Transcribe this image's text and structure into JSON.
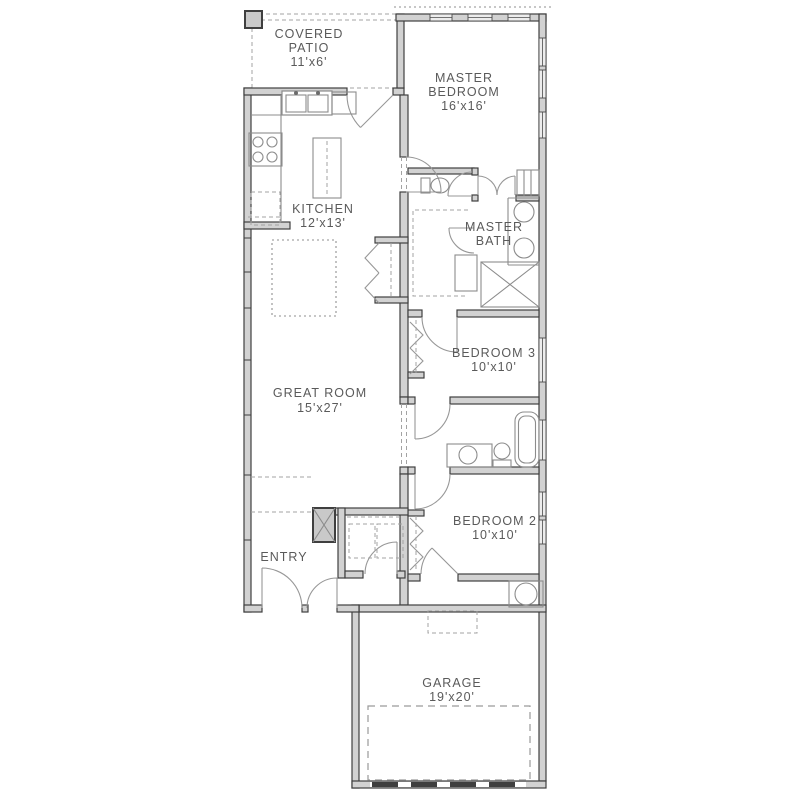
{
  "meta": {
    "type": "floor-plan-drawing",
    "background": "#ffffff"
  },
  "palette": {
    "wall_fill": "#d2d2d2",
    "wall_line": "#3f3f3f",
    "fixture_line": "#8c8c8c",
    "door_line": "#979797",
    "dashed_line": "#9a9a9a",
    "label_color": "#5a5a5a"
  },
  "rooms": {
    "covered_patio": {
      "name_line1": "COVERED",
      "name_line2": "PATIO",
      "dims": "11'x6'"
    },
    "master_bedroom": {
      "name_line1": "MASTER",
      "name_line2": "BEDROOM",
      "dims": "16'x16'"
    },
    "kitchen": {
      "name": "KITCHEN",
      "dims": "12'x13'"
    },
    "master_bath": {
      "name_line1": "MASTER",
      "name_line2": "BATH"
    },
    "great_room": {
      "name": "GREAT ROOM",
      "dims": "15'x27'"
    },
    "bedroom_3": {
      "name": "BEDROOM 3",
      "dims": "10'x10'"
    },
    "bedroom_2": {
      "name": "BEDROOM 2",
      "dims": "10'x10'"
    },
    "entry": {
      "name": "ENTRY"
    },
    "garage": {
      "name": "GARAGE",
      "dims": "19'x20'"
    }
  },
  "fixtures": [
    "kitchen-double-sink",
    "kitchen-range",
    "refrigerator-space",
    "kitchen-island",
    "pantry-bifold-doors",
    "master-toilet",
    "master-double-vanity",
    "walk-in-shower",
    "walk-in-closet-shelving",
    "linen-closet",
    "hall-bath-tub",
    "hall-bath-toilet",
    "hall-bath-vanity",
    "bedroom-closet-bifolds",
    "washer-dryer-space",
    "water-heater",
    "garage-door-opening",
    "patio-column"
  ]
}
